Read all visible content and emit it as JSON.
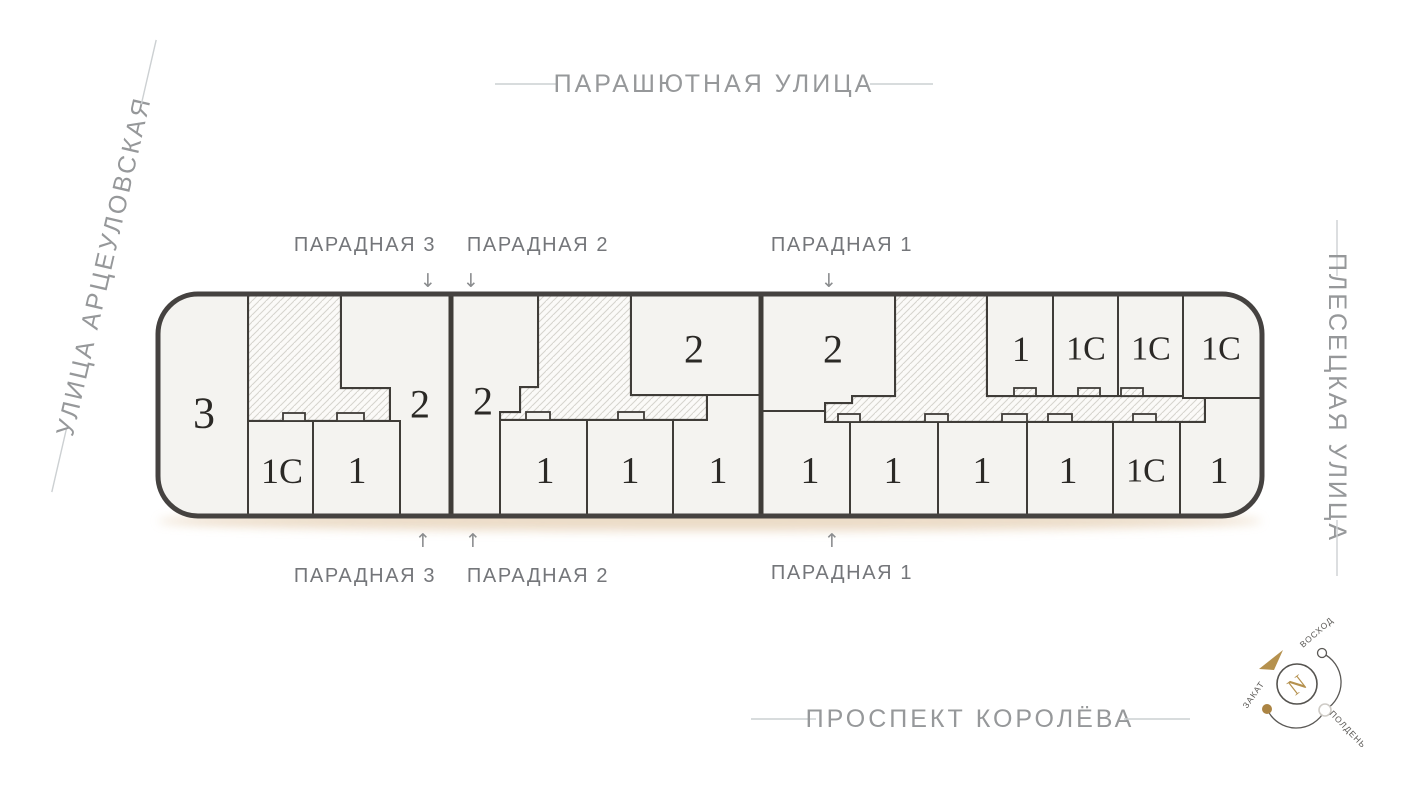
{
  "streets": {
    "top": "ПАРАШЮТНАЯ УЛИЦА",
    "left": "УЛИЦА АРЦЕУЛОВСКАЯ",
    "right": "ПЛЕСЕЦКАЯ УЛИЦА",
    "bottom": "ПРОСПЕКТ КОРОЛЁВА"
  },
  "entrances": {
    "top": [
      {
        "label": "ПАРАДНАЯ 3"
      },
      {
        "label": "ПАРАДНАЯ 2"
      },
      {
        "label": "ПАРАДНАЯ 1"
      }
    ],
    "bottom": [
      {
        "label": "ПАРАДНАЯ 3"
      },
      {
        "label": "ПАРАДНАЯ 2"
      },
      {
        "label": "ПАРАДНАЯ 1"
      }
    ],
    "arrow_down": "↓",
    "arrow_up": "↑"
  },
  "compass": {
    "north": "N",
    "sunrise": "ВОСХОД",
    "noon": "ПОЛДЕНЬ",
    "sunset": "ЗАКАТ"
  },
  "building": {
    "units": [
      {
        "label": "3",
        "points": "158,294 248,294 248,516 158,516",
        "lx": 204,
        "ly": 413,
        "fs": 44
      },
      {
        "label": "2",
        "points": "341,294 451,294 451,516 400,516 400,421 390,421 390,388 341,388",
        "lx": 420,
        "ly": 404,
        "fs": 40
      },
      {
        "label": "1С",
        "points": "248,421 313,421 313,516 248,516",
        "lx": 282,
        "ly": 471,
        "fs": 36
      },
      {
        "label": "1",
        "points": "313,421 400,421 400,516 313,516",
        "lx": 357,
        "ly": 471,
        "fs": 38
      },
      {
        "label": "2",
        "points": "451,294 538,294 538,387 520,387 520,412 500,412 500,516 451,516",
        "lx": 483,
        "ly": 401,
        "fs": 40
      },
      {
        "label": "2",
        "points": "631,294 760,294 760,395 631,395",
        "lx": 694,
        "ly": 349,
        "fs": 40
      },
      {
        "label": "1",
        "points": "500,420 587,420 587,516 500,516",
        "lx": 545,
        "ly": 471,
        "fs": 38
      },
      {
        "label": "1",
        "points": "587,420 673,420 673,516 587,516",
        "lx": 630,
        "ly": 471,
        "fs": 38
      },
      {
        "label": "1",
        "points": "673,420 707,420 707,395 760,395 760,516 673,516",
        "lx": 718,
        "ly": 471,
        "fs": 38
      },
      {
        "label": "2",
        "points": "761,294 895,294 895,396 852,396 852,403 825,403 825,411 761,411",
        "lx": 833,
        "ly": 349,
        "fs": 40
      },
      {
        "label": "1",
        "points": "987,294 1053,294 1053,396 987,396",
        "lx": 1021,
        "ly": 349,
        "fs": 36
      },
      {
        "label": "1С",
        "points": "1053,294 1118,294 1118,396 1053,396",
        "lx": 1086,
        "ly": 349,
        "fs": 34
      },
      {
        "label": "1С",
        "points": "1118,294 1183,294 1183,396 1118,396",
        "lx": 1151,
        "ly": 349,
        "fs": 34
      },
      {
        "label": "1С",
        "points": "1183,294 1262,294 1262,398 1183,398",
        "lx": 1221,
        "ly": 349,
        "fs": 34
      },
      {
        "label": "1",
        "points": "761,411 825,411 825,422 850,422 850,516 761,516",
        "lx": 810,
        "ly": 471,
        "fs": 38
      },
      {
        "label": "1",
        "points": "850,422 938,422 938,516 850,516",
        "lx": 893,
        "ly": 471,
        "fs": 38
      },
      {
        "label": "1",
        "points": "938,422 1027,422 1027,516 938,516",
        "lx": 982,
        "ly": 471,
        "fs": 38
      },
      {
        "label": "1",
        "points": "1027,422 1113,422 1113,516 1027,516",
        "lx": 1068,
        "ly": 471,
        "fs": 38
      },
      {
        "label": "1С",
        "points": "1113,422 1180,422 1180,516 1113,516",
        "lx": 1146,
        "ly": 471,
        "fs": 34
      },
      {
        "label": "1",
        "points": "1180,422 1205,422 1205,398 1262,398 1262,516 1180,516",
        "lx": 1219,
        "ly": 471,
        "fs": 38
      }
    ],
    "stairwells": [
      {
        "points": "248,294 341,294 341,388 390,388 390,421 248,421"
      },
      {
        "points": "538,294 631,294 631,395 707,395 707,420 500,420 500,412 520,412 520,387 538,387"
      },
      {
        "points": "895,294 987,294 987,396 1205,396 1205,422 825,422 825,403 852,403 852,396 895,396"
      }
    ],
    "vestibules": [
      {
        "x": 283,
        "y": 413,
        "w": 22,
        "h": 8
      },
      {
        "x": 337,
        "y": 413,
        "w": 27,
        "h": 8
      },
      {
        "x": 526,
        "y": 412,
        "w": 24,
        "h": 8
      },
      {
        "x": 618,
        "y": 412,
        "w": 26,
        "h": 8
      },
      {
        "x": 838,
        "y": 414,
        "w": 22,
        "h": 8
      },
      {
        "x": 925,
        "y": 414,
        "w": 23,
        "h": 8
      },
      {
        "x": 1002,
        "y": 414,
        "w": 25,
        "h": 8
      },
      {
        "x": 1048,
        "y": 414,
        "w": 24,
        "h": 8
      },
      {
        "x": 1133,
        "y": 414,
        "w": 23,
        "h": 8
      },
      {
        "x": 1014,
        "y": 388,
        "w": 22,
        "h": 8,
        "hatch": true
      },
      {
        "x": 1078,
        "y": 388,
        "w": 22,
        "h": 8,
        "hatch": true
      },
      {
        "x": 1121,
        "y": 388,
        "w": 22,
        "h": 8,
        "hatch": true
      }
    ],
    "dividers_x": [
      451,
      761
    ]
  },
  "colors": {
    "wall": "#3f3c38",
    "outline": "#454240",
    "building_fill": "#f4f3f0",
    "hatch_line": "#d6d3cd",
    "hatch_bg": "#fbfaf8",
    "unit_text": "#2b2926",
    "street_text": "#96989a",
    "street_line": "#ccd0d2",
    "entrance_text": "#74767a",
    "arrow": "#8b8d8f",
    "accent_gold": "#b5914e",
    "shadow": "#e8d5bd"
  }
}
